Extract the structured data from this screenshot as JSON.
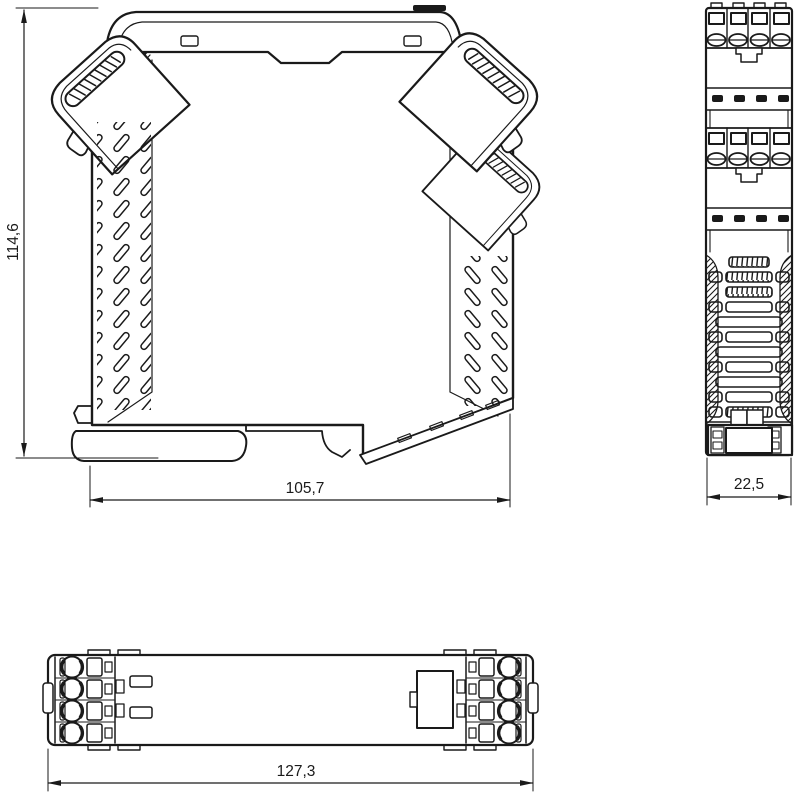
{
  "dimensions": {
    "side_height": "114,6",
    "side_width": "105,7",
    "front_width": "22,5",
    "top_width": "127,3"
  },
  "colors": {
    "line": "#1a1a1a",
    "background": "#ffffff"
  }
}
